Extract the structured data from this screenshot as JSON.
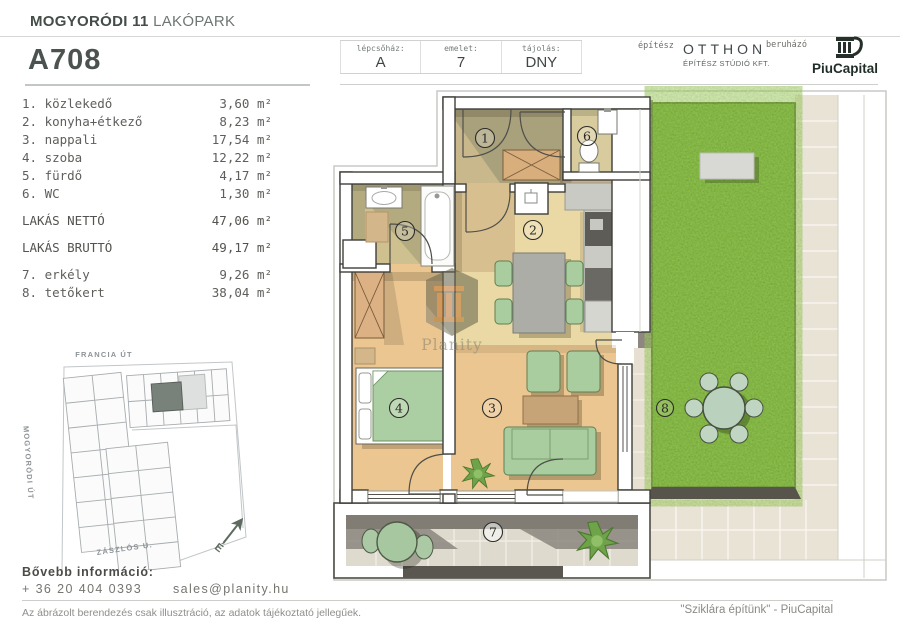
{
  "header": {
    "project_bold": "MOGYORÓDI 11",
    "project_light": "LAKÓPARK",
    "unit_id": "A708",
    "info": [
      {
        "label": "lépcsőház:",
        "value": "A"
      },
      {
        "label": "emelet:",
        "value": "7"
      },
      {
        "label": "tájolás:",
        "value": "DNY"
      }
    ],
    "architect_label": "építész",
    "architect_name": "OTTHON",
    "architect_sub": "ÉPÍTÉSZ STÚDIÓ KFT.",
    "developer_label": "beruházó",
    "developer_name": "PiuCapital"
  },
  "rooms": [
    {
      "label": "1. közlekedő",
      "area": "3,60 m²"
    },
    {
      "label": "2. konyha+étkező",
      "area": "8,23 m²"
    },
    {
      "label": "3. nappali",
      "area": "17,54 m²"
    },
    {
      "label": "4. szoba",
      "area": "12,22 m²"
    },
    {
      "label": "5. fürdő",
      "area": "4,17 m²"
    },
    {
      "label": "6. WC",
      "area": "1,30 m²"
    }
  ],
  "totals": [
    {
      "label": "LAKÁS NETTÓ",
      "area": "47,06 m²"
    },
    {
      "label": "LAKÁS BRUTTÓ",
      "area": "49,17 m²"
    }
  ],
  "outdoor": [
    {
      "label": "7. erkély",
      "area": "9,26 m²"
    },
    {
      "label": "8. tetőkert",
      "area": "38,04 m²"
    }
  ],
  "floorplan": {
    "labels": [
      "1",
      "2",
      "3",
      "4",
      "5",
      "6",
      "7",
      "8"
    ],
    "watermark": "Planity"
  },
  "sitemap": {
    "street_top": "FRANCIA ÚT",
    "street_left": "MOGYORÓDI ÚT",
    "street_bottom": "ZÁSZLÓS U.",
    "compass": "É"
  },
  "footer": {
    "info_title": "Bővebb információ:",
    "phone": "+ 36 20 404 0393",
    "email": "sales@planity.hu",
    "disclaimer": "Az ábrázolt berendezés csak illusztráció, az adatok tájékoztató jellegűek.",
    "slogan": "\"Sziklára építünk\" - PiuCapital"
  },
  "colors": {
    "brand_dark": "#22302a",
    "text_dark": "#474f4b",
    "grass": "#6ba32d",
    "wood_floor": "#ecc690",
    "furniture_green": "#a9cd9f"
  }
}
